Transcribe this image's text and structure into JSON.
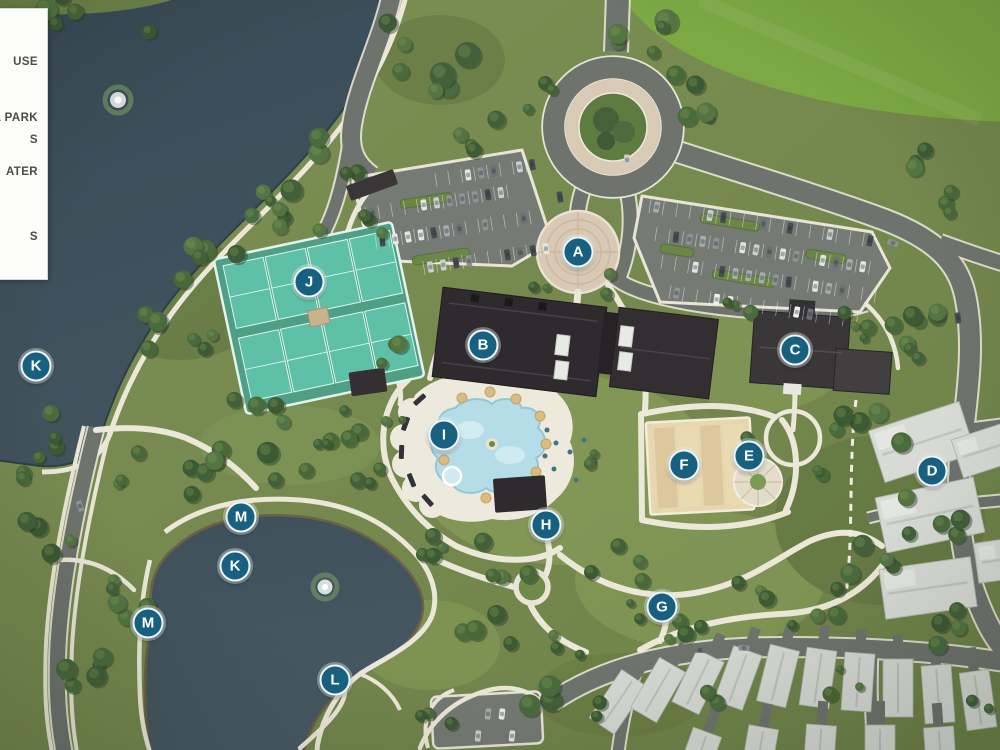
{
  "legend": {
    "entries": [
      {
        "label": "USE",
        "top": 47
      },
      {
        "label": "AL PARK",
        "top": 103
      },
      {
        "label": "S",
        "top": 125
      },
      {
        "label": "ATER",
        "top": 157
      },
      {
        "label": "S",
        "top": 222
      }
    ]
  },
  "markers": [
    {
      "letter": "A",
      "x": 578,
      "y": 252
    },
    {
      "letter": "B",
      "x": 483,
      "y": 345
    },
    {
      "letter": "C",
      "x": 795,
      "y": 350
    },
    {
      "letter": "D",
      "x": 932,
      "y": 471
    },
    {
      "letter": "E",
      "x": 749,
      "y": 456
    },
    {
      "letter": "F",
      "x": 684,
      "y": 465
    },
    {
      "letter": "G",
      "x": 662,
      "y": 607
    },
    {
      "letter": "H",
      "x": 546,
      "y": 525
    },
    {
      "letter": "I",
      "x": 444,
      "y": 435
    },
    {
      "letter": "J",
      "x": 309,
      "y": 282
    },
    {
      "letter": "K",
      "x": 36,
      "y": 366
    },
    {
      "letter": "K",
      "x": 235,
      "y": 566
    },
    {
      "letter": "L",
      "x": 335,
      "y": 680
    },
    {
      "letter": "M",
      "x": 241,
      "y": 517
    },
    {
      "letter": "M",
      "x": 148,
      "y": 623
    }
  ],
  "styles": {
    "marker_fill": "#17607F",
    "marker_border": "#EEF4F5",
    "marker_text": "#FFFFFF",
    "legend_background": "#FCFCFB",
    "water_color": "#3B4D58",
    "field_color": "#7CA944"
  }
}
